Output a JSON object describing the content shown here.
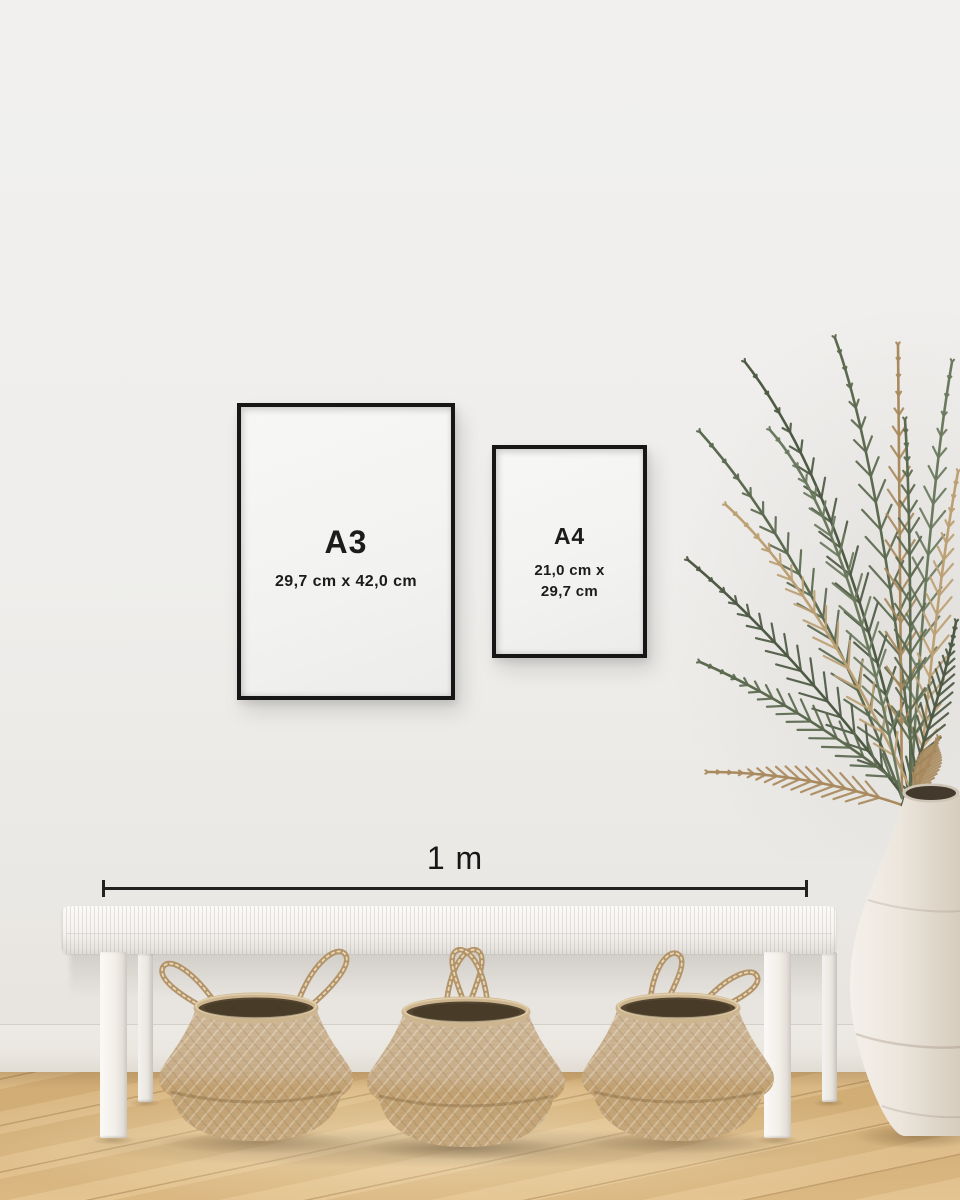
{
  "frames": [
    {
      "label": "A3",
      "dimensions": "29,7 cm x 42,0 cm"
    },
    {
      "label": "A4",
      "dimensions_line1": "21,0 cm x",
      "dimensions_line2": "29,7 cm"
    }
  ],
  "measure": {
    "label": "1 m"
  },
  "colors": {
    "wall": "#efeeec",
    "baseboard": "#eae6e0",
    "floor_wood": "#d9b57d",
    "frame_border": "#161616",
    "frame_matte": "#f3f3f1",
    "text": "#1c1c1c",
    "measure_line": "#222222",
    "bench_white": "#f6f4f0",
    "basket_light": "#cfb99a",
    "basket_dark": "#c2a171",
    "basket_rim": "#cdb590",
    "basket_opening": "#554631",
    "handle_rope": "#b3946a",
    "plant_green": "#5c6a50",
    "plant_green_dark": "#4e5a44",
    "plant_green_light": "#6b7a5e",
    "plant_tan": "#a98a5e",
    "plant_tan_light": "#bca074",
    "vase": "#ece6dd",
    "shadow": "#46321c"
  }
}
